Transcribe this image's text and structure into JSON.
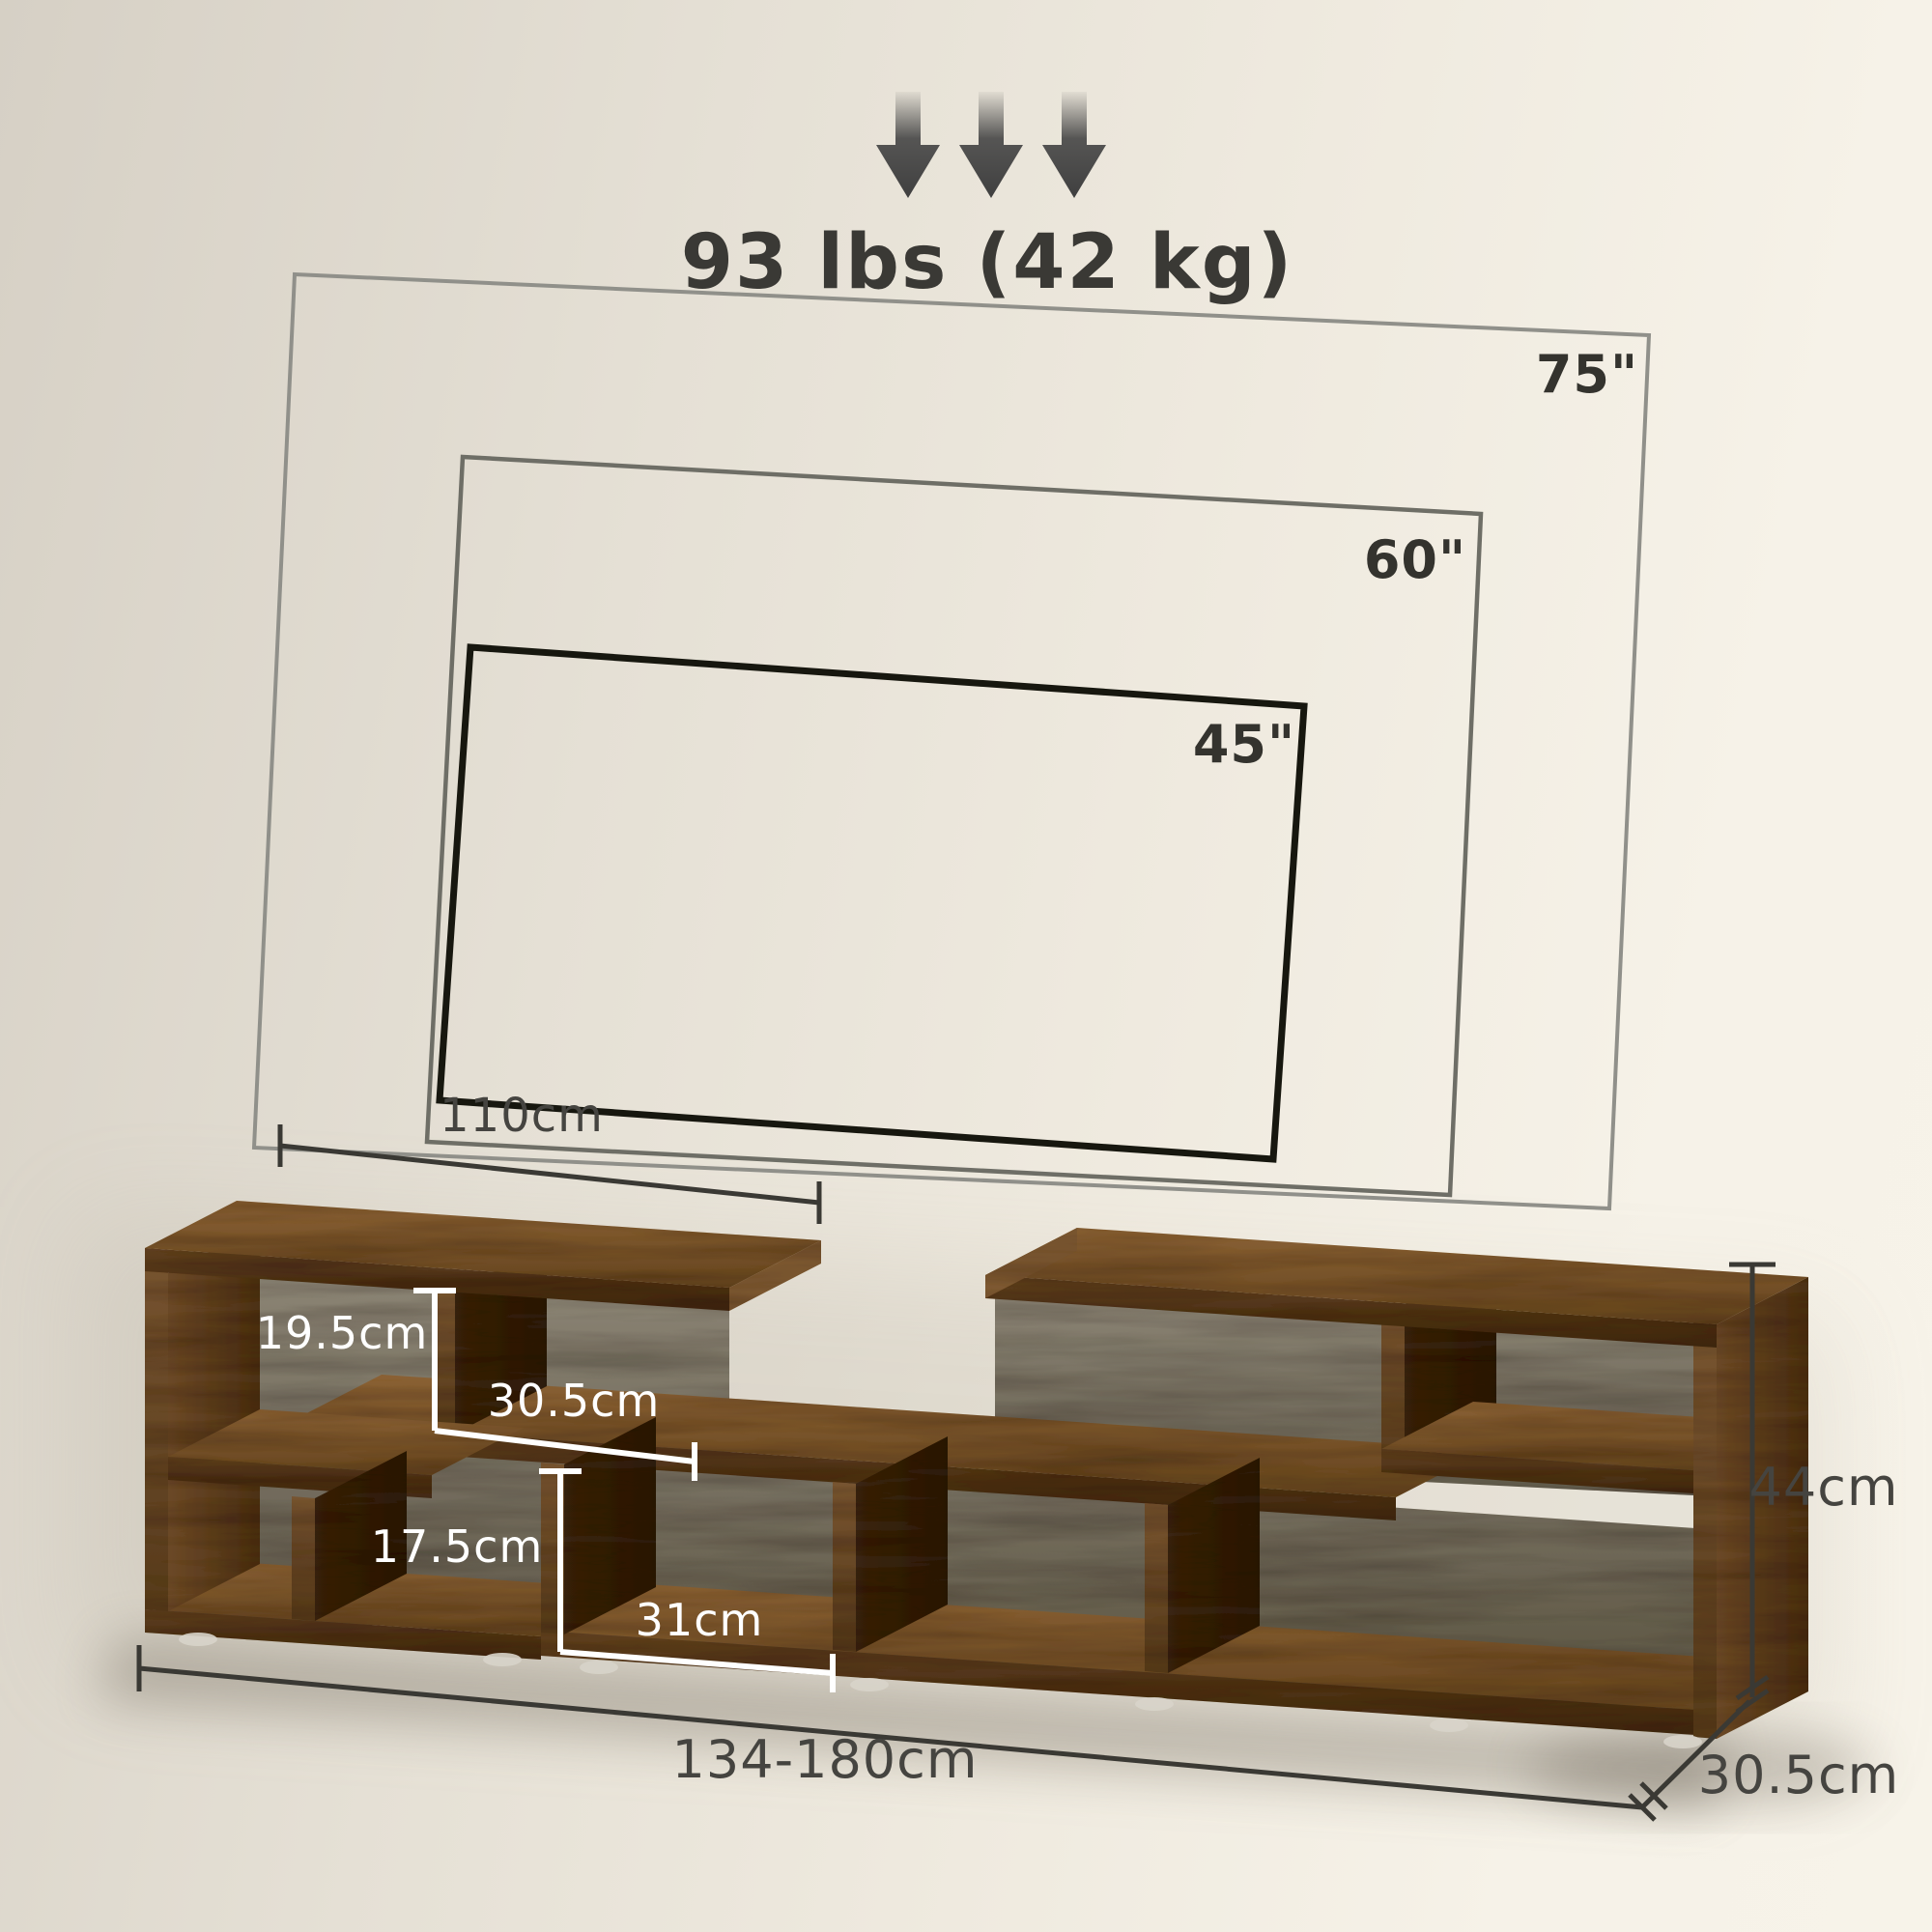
{
  "header": {
    "max_load": "93 lbs (42 kg)"
  },
  "tv_overlay": {
    "sizes": [
      {
        "label": "75\""
      },
      {
        "label": "60\""
      },
      {
        "label": "45\""
      }
    ]
  },
  "stand_dimensions": {
    "top_section_width": "110cm",
    "upper_compartment_height": "19.5cm",
    "upper_compartment_width": "30.5cm",
    "lower_compartment_height": "17.5cm",
    "lower_compartment_width": "31cm",
    "overall_height": "44cm",
    "adjustable_width": "134-180cm",
    "depth": "30.5cm"
  },
  "colors": {
    "background_start": "#d6d0c5",
    "background_end": "#f7f3e9",
    "wood_top": "#8a6134",
    "wood_front": "#5e3e20",
    "wood_shadow_side": "#38220e",
    "dimension_dark": "#3a3934",
    "dimension_light": "#ffffff",
    "tv_75_line": "#90908a",
    "tv_60_line": "#6e6e66",
    "tv_45_line": "#17170f",
    "arrow": "#454545"
  }
}
